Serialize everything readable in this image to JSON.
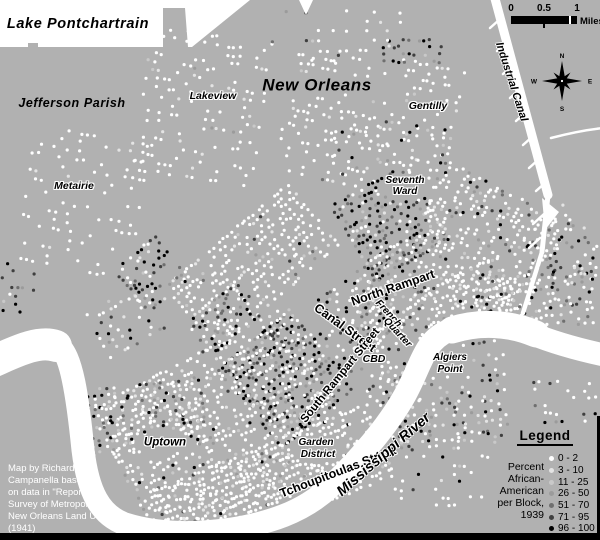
{
  "colors": {
    "land": "#b1b1b1",
    "water": "#ffffff",
    "border": "#000000",
    "attribution_text": "#ffffff",
    "dot_shades": [
      "#ffffff",
      "#e4e4e4",
      "#c9c9c9",
      "#9b9b9b",
      "#6f6f6f",
      "#3f3f3f",
      "#000000"
    ]
  },
  "scale_bar": {
    "ticks": [
      "0",
      "0.5",
      "1"
    ],
    "unit": "Miles"
  },
  "compass": {
    "n": "N",
    "e": "E",
    "s": "S",
    "w": "W"
  },
  "legend": {
    "title": "Legend",
    "description_lines": [
      "Percent",
      "African-",
      "American",
      "per Block,",
      "1939"
    ],
    "items": [
      {
        "label": "0 - 2",
        "shade": 0
      },
      {
        "label": "3 - 10",
        "shade": 1
      },
      {
        "label": "11 - 25",
        "shade": 2
      },
      {
        "label": "26 - 50",
        "shade": 3
      },
      {
        "label": "51 - 70",
        "shade": 4
      },
      {
        "label": "71 - 95",
        "shade": 5
      },
      {
        "label": "96 - 100",
        "shade": 6
      }
    ]
  },
  "attribution_lines": [
    "Map by Richard",
    "Campanella based",
    "on data in \"Report on",
    "Survey of Metropolitan",
    "New Orleans Land Use\"",
    "(1941)"
  ],
  "labels": [
    {
      "name": "lake-pontchartrain",
      "text": "Lake Pontchartrain",
      "x": 78,
      "y": 24,
      "size": 14.5,
      "rot": 0,
      "cls": "big"
    },
    {
      "name": "jefferson-parish",
      "text": "Jefferson Parish",
      "x": 72,
      "y": 103,
      "size": 12.5,
      "rot": 0,
      "cls": "big"
    },
    {
      "name": "new-orleans",
      "text": "New Orleans",
      "x": 317,
      "y": 85,
      "size": 17,
      "rot": 0,
      "cls": "big"
    },
    {
      "name": "lakeview",
      "text": "Lakeview",
      "x": 213,
      "y": 96,
      "size": 10.5,
      "rot": 0,
      "cls": "place"
    },
    {
      "name": "metairie",
      "text": "Metairie",
      "x": 74,
      "y": 186,
      "size": 10.5,
      "rot": 0,
      "cls": "place"
    },
    {
      "name": "gentilly",
      "text": "Gentilly",
      "x": 428,
      "y": 106,
      "size": 10.5,
      "rot": 0,
      "cls": "place"
    },
    {
      "name": "seventh-ward-1",
      "text": "Seventh",
      "x": 405,
      "y": 181,
      "size": 10,
      "rot": 0,
      "cls": "place"
    },
    {
      "name": "seventh-ward-2",
      "text": "Ward",
      "x": 405,
      "y": 192,
      "size": 10,
      "rot": 0,
      "cls": "place"
    },
    {
      "name": "uptown",
      "text": "Uptown",
      "x": 165,
      "y": 443,
      "size": 11.5,
      "rot": 0,
      "cls": "place"
    },
    {
      "name": "garden-district-1",
      "text": "Garden",
      "x": 316,
      "y": 443,
      "size": 10,
      "rot": 0,
      "cls": "place"
    },
    {
      "name": "garden-district-2",
      "text": "District",
      "x": 318,
      "y": 455,
      "size": 10,
      "rot": 0,
      "cls": "place"
    },
    {
      "name": "cbd",
      "text": "CBD",
      "x": 374,
      "y": 359,
      "size": 10.5,
      "rot": 0,
      "cls": "place"
    },
    {
      "name": "algiers-point-1",
      "text": "Algiers",
      "x": 450,
      "y": 358,
      "size": 10,
      "rot": 0,
      "cls": "place"
    },
    {
      "name": "algiers-point-2",
      "text": "Point",
      "x": 450,
      "y": 370,
      "size": 10,
      "rot": 0,
      "cls": "place"
    },
    {
      "name": "french-quarter-1",
      "text": "French",
      "x": 388,
      "y": 314,
      "size": 10,
      "rot": 47,
      "cls": "place"
    },
    {
      "name": "french-quarter-2",
      "text": "Quarter",
      "x": 397,
      "y": 333,
      "size": 10,
      "rot": 47,
      "cls": "place"
    },
    {
      "name": "canal-street",
      "text": "Canal Street",
      "x": 345,
      "y": 328,
      "size": 12.5,
      "rot": 36,
      "cls": "street"
    },
    {
      "name": "north-rampart",
      "text": "North Rampart",
      "x": 393,
      "y": 288,
      "size": 12.5,
      "rot": -19,
      "cls": "street"
    },
    {
      "name": "south-rampart",
      "text": "South Rampart Street",
      "x": 341,
      "y": 376,
      "size": 11.5,
      "rot": -51,
      "cls": "street"
    },
    {
      "name": "tchoupitoulas",
      "text": "Tchoupitoulas Street",
      "x": 338,
      "y": 472,
      "size": 12.5,
      "rot": -21,
      "cls": "street"
    },
    {
      "name": "mississippi-river",
      "text": "Mississippi River",
      "x": 384,
      "y": 455,
      "size": 14.5,
      "rot": -41,
      "cls": "water"
    },
    {
      "name": "industrial-canal",
      "text": "Industrial Canal",
      "x": 511,
      "y": 82,
      "size": 11,
      "rot": 72,
      "cls": "water"
    }
  ],
  "water": {
    "lake_path": "M0,0 L250,0 L192,47 L188,47 L185,8 L163,8 L163,47 L38,47 L38,43 L28,43 L28,47 L0,47 Z",
    "lake_wedge": "M299,0 L313,0 L306,15 Z",
    "river_center": "M-6,362 C20,352 42,338 57,345 C72,353 78,400 83,450 C88,492 100,515 125,524 C160,535 198,534 232,529 C268,523 302,513 330,487 C356,462 386,429 405,395 C415,377 420,360 428,348 C438,332 455,326 478,324 C500,322 515,326 530,333 C552,342 576,349 604,355",
    "river_width": 23,
    "river_wide_segments": [
      {
        "d": "M-8,362 C15,352 38,340 56,346",
        "w": 32
      },
      {
        "d": "M452,330 C478,322 508,322 536,334",
        "w": 27
      }
    ],
    "canal_segments": [
      {
        "d": "M494,-5 L548,195",
        "w": 9
      },
      {
        "d": "M548,195 L542,252",
        "w": 5
      },
      {
        "d": "M542,252 L523,313",
        "w": 4.5
      },
      {
        "d": "M551,138 C570,133 585,130 603,128",
        "w": 2.5
      }
    ],
    "canal_flare": "M542,198 L559,212 L545,230 Z",
    "hatches": [
      [
        499,
        20,
        490,
        28
      ],
      [
        506,
        43,
        497,
        51
      ],
      [
        512,
        66,
        503,
        74
      ],
      [
        519,
        90,
        510,
        98
      ],
      [
        525,
        113,
        516,
        121
      ],
      [
        532,
        137,
        523,
        145
      ],
      [
        538,
        160,
        529,
        168
      ],
      [
        545,
        183,
        536,
        191
      ],
      [
        544,
        214,
        533,
        224
      ],
      [
        540,
        238,
        529,
        248
      ]
    ]
  },
  "clear_zones": [
    {
      "cx": 165,
      "cy": 443,
      "rx": 32,
      "ry": 11
    },
    {
      "cx": 317,
      "cy": 449,
      "rx": 28,
      "ry": 15
    },
    {
      "cx": 405,
      "cy": 186,
      "rx": 28,
      "ry": 13
    },
    {
      "cx": 428,
      "cy": 106,
      "rx": 26,
      "ry": 8
    },
    {
      "cx": 74,
      "cy": 186,
      "rx": 26,
      "ry": 8
    },
    {
      "cx": 213,
      "cy": 96,
      "rx": 25,
      "ry": 8
    },
    {
      "cx": 374,
      "cy": 359,
      "rx": 15,
      "ry": 7
    },
    {
      "cx": 450,
      "cy": 364,
      "rx": 24,
      "ry": 13
    },
    {
      "cx": 317,
      "cy": 85,
      "rx": 62,
      "ry": 10
    },
    {
      "cx": 50,
      "cy": 497,
      "rx": 52,
      "ry": 36
    },
    {
      "cx": 71,
      "cy": 103,
      "rx": 50,
      "ry": 9
    }
  ],
  "dot_clusters": [
    {
      "name": "lakeview",
      "cx": 202,
      "cy": 110,
      "w": 120,
      "h": 150,
      "rot": 8,
      "s": 7,
      "p": 0.34,
      "wts": [
        84,
        10,
        3,
        1,
        1,
        1,
        0
      ]
    },
    {
      "name": "metairie",
      "cx": 85,
      "cy": 205,
      "w": 120,
      "h": 140,
      "rot": 10,
      "s": 7.5,
      "p": 0.26,
      "wts": [
        90,
        6,
        2,
        1,
        1,
        0,
        0
      ]
    },
    {
      "name": "jefferson-dark",
      "cx": 18,
      "cy": 292,
      "w": 36,
      "h": 55,
      "rot": 5,
      "s": 6.5,
      "p": 0.33,
      "wts": [
        12,
        6,
        6,
        10,
        12,
        22,
        32
      ]
    },
    {
      "name": "hollygrove",
      "cx": 128,
      "cy": 322,
      "w": 65,
      "h": 55,
      "rot": -30,
      "s": 6,
      "p": 0.42,
      "wts": [
        42,
        10,
        6,
        6,
        6,
        12,
        18
      ]
    },
    {
      "name": "gentilly",
      "cx": 370,
      "cy": 125,
      "w": 170,
      "h": 140,
      "rot": 12,
      "s": 6.5,
      "p": 0.34,
      "wts": [
        86,
        7,
        3,
        2,
        1,
        1,
        0
      ]
    },
    {
      "name": "gentilly-dark",
      "cx": 413,
      "cy": 52,
      "w": 58,
      "h": 24,
      "rot": 0,
      "s": 6,
      "p": 0.5,
      "wts": [
        6,
        5,
        5,
        6,
        10,
        22,
        46
      ]
    },
    {
      "name": "fairgrounds",
      "cx": 392,
      "cy": 152,
      "w": 115,
      "h": 60,
      "rot": 8,
      "s": 7,
      "p": 0.3,
      "wts": [
        58,
        10,
        5,
        5,
        5,
        7,
        10
      ]
    },
    {
      "name": "seventh-dark",
      "cx": 392,
      "cy": 225,
      "w": 85,
      "h": 92,
      "rot": -30,
      "s": 5.5,
      "p": 0.72,
      "wts": [
        9,
        5,
        5,
        8,
        12,
        24,
        37
      ]
    },
    {
      "name": "seventh-white",
      "cx": 487,
      "cy": 240,
      "w": 112,
      "h": 135,
      "rot": -62,
      "s": 5.5,
      "p": 0.6,
      "wts": [
        70,
        12,
        5,
        4,
        3,
        3,
        3
      ]
    },
    {
      "name": "treme",
      "cx": 378,
      "cy": 300,
      "w": 95,
      "h": 70,
      "rot": -36,
      "s": 5.5,
      "p": 0.55,
      "wts": [
        38,
        10,
        7,
        8,
        9,
        12,
        16
      ]
    },
    {
      "name": "midcity-white",
      "cx": 255,
      "cy": 268,
      "w": 160,
      "h": 85,
      "rot": -40,
      "s": 5.5,
      "p": 0.55,
      "wts": [
        78,
        10,
        4,
        3,
        2,
        2,
        1
      ]
    },
    {
      "name": "midcity-dark-1",
      "cx": 155,
      "cy": 275,
      "w": 55,
      "h": 58,
      "rot": -40,
      "s": 5.5,
      "p": 0.55,
      "wts": [
        14,
        6,
        5,
        8,
        12,
        22,
        33
      ]
    },
    {
      "name": "midcity-dark-2",
      "cx": 225,
      "cy": 322,
      "w": 62,
      "h": 45,
      "rot": -40,
      "s": 5.5,
      "p": 0.5,
      "wts": [
        20,
        6,
        5,
        8,
        12,
        20,
        29
      ]
    },
    {
      "name": "central-city",
      "cx": 287,
      "cy": 378,
      "w": 95,
      "h": 100,
      "rot": -40,
      "s": 5.2,
      "p": 0.7,
      "wts": [
        12,
        5,
        5,
        8,
        12,
        24,
        34
      ]
    },
    {
      "name": "cbd-fq",
      "cx": 380,
      "cy": 342,
      "w": 90,
      "h": 95,
      "rot": -46,
      "s": 5.5,
      "p": 0.45,
      "wts": [
        55,
        10,
        5,
        6,
        6,
        8,
        10
      ]
    },
    {
      "name": "marigny",
      "cx": 467,
      "cy": 302,
      "w": 95,
      "h": 55,
      "rot": -25,
      "s": 5.5,
      "p": 0.55,
      "wts": [
        74,
        10,
        5,
        4,
        2,
        2,
        3
      ]
    },
    {
      "name": "uptown",
      "cx": 227,
      "cy": 432,
      "w": 220,
      "h": 165,
      "rot": -28,
      "s": 5.5,
      "p": 0.56,
      "wts": [
        75,
        10,
        4,
        3,
        2,
        2,
        4
      ]
    },
    {
      "name": "carrollton",
      "cx": 138,
      "cy": 420,
      "w": 68,
      "h": 130,
      "rot": 84,
      "s": 5.5,
      "p": 0.55,
      "wts": [
        45,
        8,
        6,
        7,
        8,
        11,
        15
      ]
    },
    {
      "name": "riverfront",
      "cx": 275,
      "cy": 485,
      "w": 230,
      "h": 80,
      "rot": -22,
      "s": 5.2,
      "p": 0.6,
      "wts": [
        85,
        8,
        3,
        2,
        1,
        1,
        0
      ]
    },
    {
      "name": "algiers",
      "cx": 442,
      "cy": 402,
      "w": 88,
      "h": 128,
      "rot": 86,
      "s": 6,
      "p": 0.42,
      "wts": [
        44,
        10,
        8,
        7,
        8,
        10,
        13
      ]
    },
    {
      "name": "algiers-scatter",
      "cx": 440,
      "cy": 455,
      "w": 100,
      "h": 110,
      "rot": 0,
      "s": 6.8,
      "p": 0.26,
      "wts": [
        48,
        10,
        6,
        6,
        8,
        10,
        12
      ]
    },
    {
      "name": "ninth-east",
      "cx": 570,
      "cy": 258,
      "w": 58,
      "h": 88,
      "rot": -40,
      "s": 6.2,
      "p": 0.48,
      "wts": [
        34,
        8,
        6,
        8,
        10,
        14,
        20
      ]
    },
    {
      "name": "bywater-east",
      "cx": 529,
      "cy": 307,
      "w": 142,
      "h": 62,
      "rot": -10,
      "s": 6,
      "p": 0.5,
      "wts": [
        56,
        8,
        5,
        6,
        6,
        8,
        11
      ]
    },
    {
      "name": "se-river",
      "cx": 567,
      "cy": 405,
      "w": 65,
      "h": 45,
      "rot": 0,
      "s": 6.5,
      "p": 0.3,
      "wts": [
        40,
        10,
        5,
        5,
        8,
        12,
        20
      ]
    },
    {
      "name": "lakefront-scatter",
      "cx": 335,
      "cy": 38,
      "w": 140,
      "h": 52,
      "rot": 0,
      "s": 8,
      "p": 0.2,
      "wts": [
        70,
        6,
        4,
        4,
        4,
        5,
        7
      ]
    }
  ]
}
